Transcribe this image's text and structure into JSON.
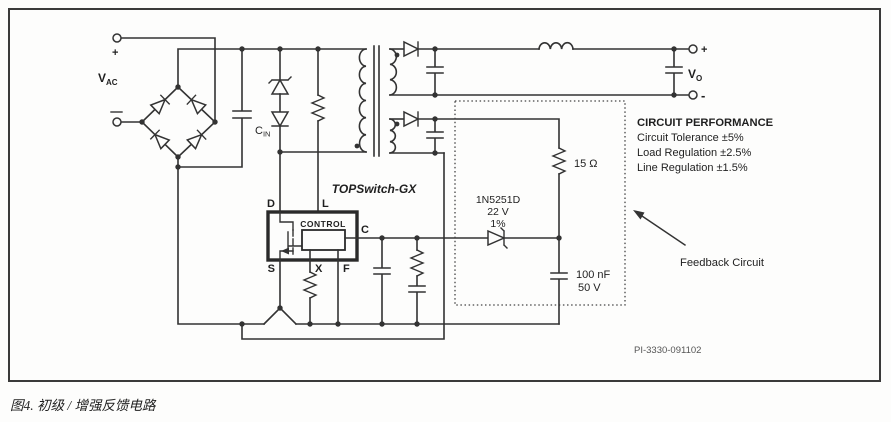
{
  "colors": {
    "wire": "#333333",
    "text": "#1f1f1f",
    "part_number_text": "#555555",
    "caption_text": "#6a6e60",
    "background": "#fdfdfc"
  },
  "input": {
    "v_label": "V",
    "v_sub": "AC",
    "plus_mark": "+",
    "cap_label": "C",
    "cap_sub": "IN"
  },
  "device": {
    "name": "TOPSwitch-GX",
    "control": "CONTROL",
    "pin_d": "D",
    "pin_l": "L",
    "pin_c": "C",
    "pin_s": "S",
    "pin_x": "X",
    "pin_f": "F"
  },
  "feedback": {
    "zener_part": "1N5251D",
    "zener_v": "22 V",
    "zener_tol": "1%",
    "res_value": "15 Ω",
    "cap_value": "100 nF",
    "cap_v": "50 V",
    "label": "Feedback Circuit"
  },
  "output": {
    "v_label": "V",
    "v_sub": "O",
    "plus_mark": "+",
    "minus_mark": "-"
  },
  "performance": {
    "title": "CIRCUIT PERFORMANCE",
    "lines": [
      "Circuit Tolerance ±5%",
      "Load Regulation ±2.5%",
      "Line Regulation ±1.5%"
    ]
  },
  "part_number": "PI-3330-091102",
  "caption": "图4. 初级 / 增强反馈电路"
}
